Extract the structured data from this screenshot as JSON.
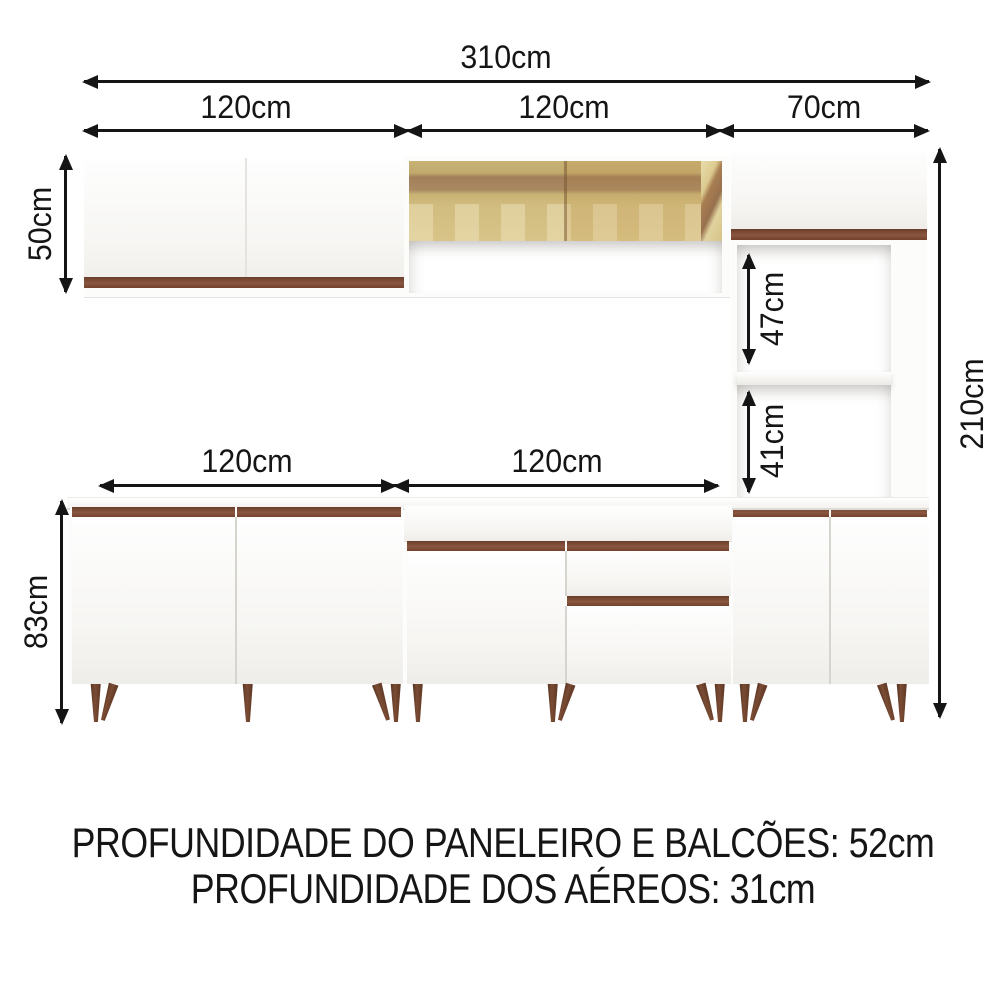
{
  "diagram": {
    "total_width": "310cm",
    "top_segments": [
      "120cm",
      "120cm",
      "70cm"
    ],
    "base_segments": [
      "120cm",
      "120cm"
    ],
    "heights": {
      "aereo": "50cm",
      "total": "210cm",
      "nicho_superior": "47cm",
      "nicho_inferior": "41cm",
      "balcao": "83cm"
    },
    "notes": [
      "PROFUNDIDADE DO PANELEIRO E BALCÕES: 52cm",
      "PROFUNDIDADE DOS AÉREOS: 31cm"
    ],
    "colors": {
      "arrow_line": "#151515",
      "wood_accent": "#7b4a33",
      "wood_leg": "#5e3826",
      "glass_amber": "#d2bd80",
      "cabinet_white": "#fcfcfa"
    }
  }
}
